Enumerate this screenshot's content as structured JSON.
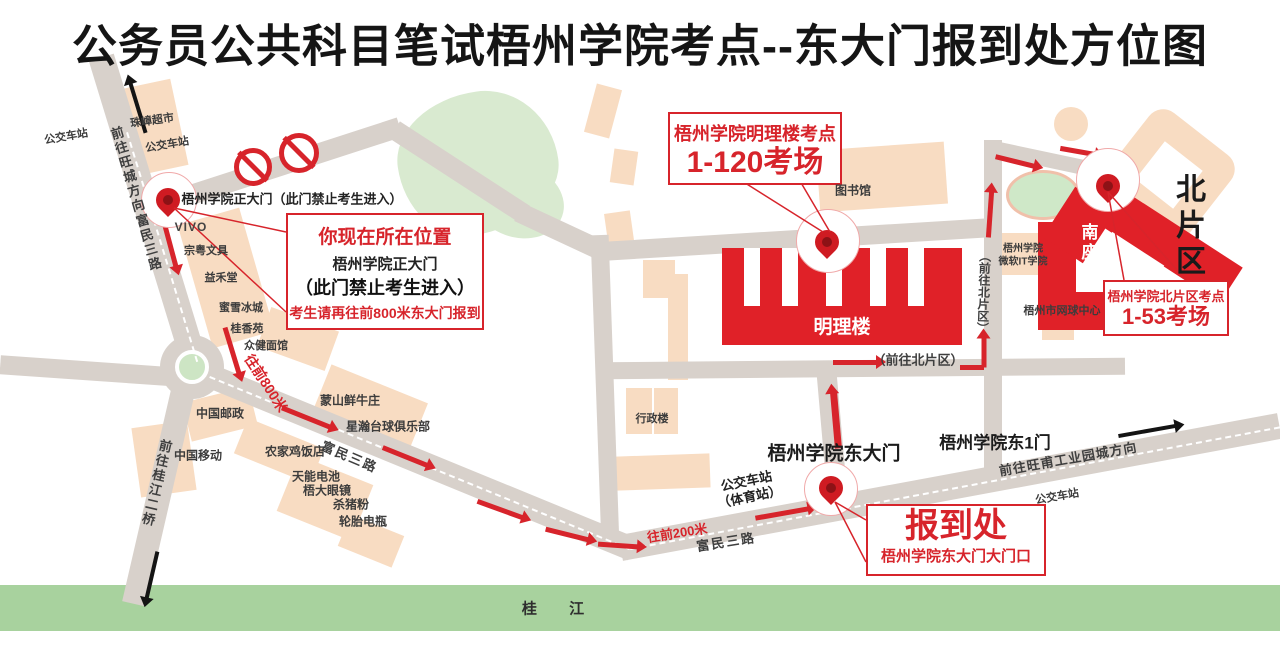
{
  "title": "公务员公共科目笔试梧州学院考点--东大门报到处方位图",
  "colors": {
    "accent_red": "#d7242b",
    "building_red": "#e02128",
    "road_gray": "#d8d1cb",
    "building_beige": "#f8dcc2",
    "green_area": "#d9ead0",
    "river_green": "#a8d29e"
  },
  "callouts": {
    "current_location": {
      "l1": "你现在所在位置",
      "l2": "梧州学院正大门",
      "l3": "（此门禁止考生进入）",
      "l4": "考生请再往前800米东大门报到"
    },
    "minglilou_site": {
      "l1": "梧州学院明理楼考点",
      "l2": "1-120考场"
    },
    "north_site": {
      "l1": "梧州学院北片区考点",
      "l2": "1-53考场"
    },
    "registration": {
      "l1": "报到处",
      "l2": "梧州学院东大门大门口"
    }
  },
  "gates": {
    "main_gate": "梧州学院正大门（此门禁止考生进入）",
    "east_gate": "梧州学院东大门",
    "east_gate_1": "梧州学院东1门"
  },
  "buildings": {
    "minglilou": "明理楼",
    "nanzuo": "南座",
    "north_area": "北片区",
    "library": "图书馆",
    "admin": "行政楼",
    "microsoft_it_1": "梧州学院",
    "microsoft_it_2": "微软IT学院",
    "tennis_center": "梧州市网球中心"
  },
  "roads": {
    "fumin_3rd_a": "富民三路",
    "fumin_3rd_b": "富民三路",
    "fumin_3rd_c": "富民三路",
    "to_wangcheng": "前往旺城方向",
    "to_guijiang_bridge": "前往桂江二桥",
    "to_north_v": "（前往北片区）",
    "to_north_h": "（前往北片区）",
    "to_wangfu": "前往旺甫工业园城方向",
    "forward_800": "往前800米",
    "forward_200": "往前200米",
    "river": "桂  江"
  },
  "pois": {
    "supermarket": "珠嶂超市",
    "bus_stop_nw1": "公交车站",
    "bus_stop_nw2": "公交车站",
    "vivo": "VIVO",
    "stationery": "宗粤文具",
    "yihetang": "益禾堂",
    "mixue": "蜜雪冰城",
    "guixiangyuan": "桂香苑",
    "noodle_house": "众健面馆",
    "china_post": "中国邮政",
    "china_mobile": "中国移动",
    "beef_house": "蒙山鲜牛庄",
    "billiards_club": "星瀚台球俱乐部",
    "farm_chicken": "农家鸡饭店",
    "tianneng_battery": "天能电池",
    "wuda_glasses": "梧大眼镜",
    "pork_noodle": "杀猪粉",
    "tire_battery": "轮胎电瓶",
    "bus_stop_gym_1": "公交车站",
    "bus_stop_gym_2": "（体育站）",
    "bus_stop_se": "公交车站"
  }
}
